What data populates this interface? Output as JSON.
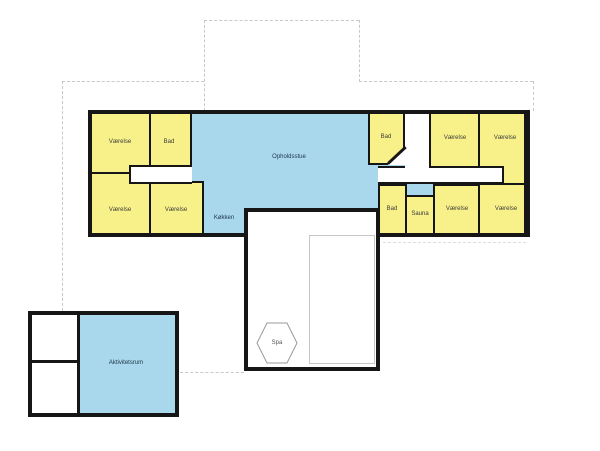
{
  "plan": {
    "type": "floor-plan",
    "colors": {
      "room_fill": "#f8f18a",
      "common_area_fill": "#a9d8ec",
      "wall": "#161616",
      "roof_outline_dash": "#c8c8c8",
      "pool_outline": "#c6c6c6"
    },
    "rooms": {
      "vaerelse_top_left": {
        "label": "Værelse"
      },
      "bad_top_left": {
        "label": "Bad"
      },
      "vaerelse_bottom_left_1": {
        "label": "Værelse"
      },
      "vaerelse_bottom_left_2": {
        "label": "Værelse"
      },
      "opholdsstue": {
        "label": "Opholdsstue"
      },
      "koekken": {
        "label": "Køkken"
      },
      "bad_top_right": {
        "label": "Bad"
      },
      "vaerelse_top_mid_right": {
        "label": "Værelse"
      },
      "vaerelse_top_far_right": {
        "label": "Værelse"
      },
      "bad_bottom_right": {
        "label": "Bad"
      },
      "sauna": {
        "label": "Sauna"
      },
      "vaerelse_bottom_mid_right": {
        "label": "Værelse"
      },
      "vaerelse_bottom_far_right": {
        "label": "Værelse"
      },
      "spa": {
        "label": "Spa"
      },
      "aktivitetsrum": {
        "label": "Aktivitetsrum"
      }
    }
  }
}
